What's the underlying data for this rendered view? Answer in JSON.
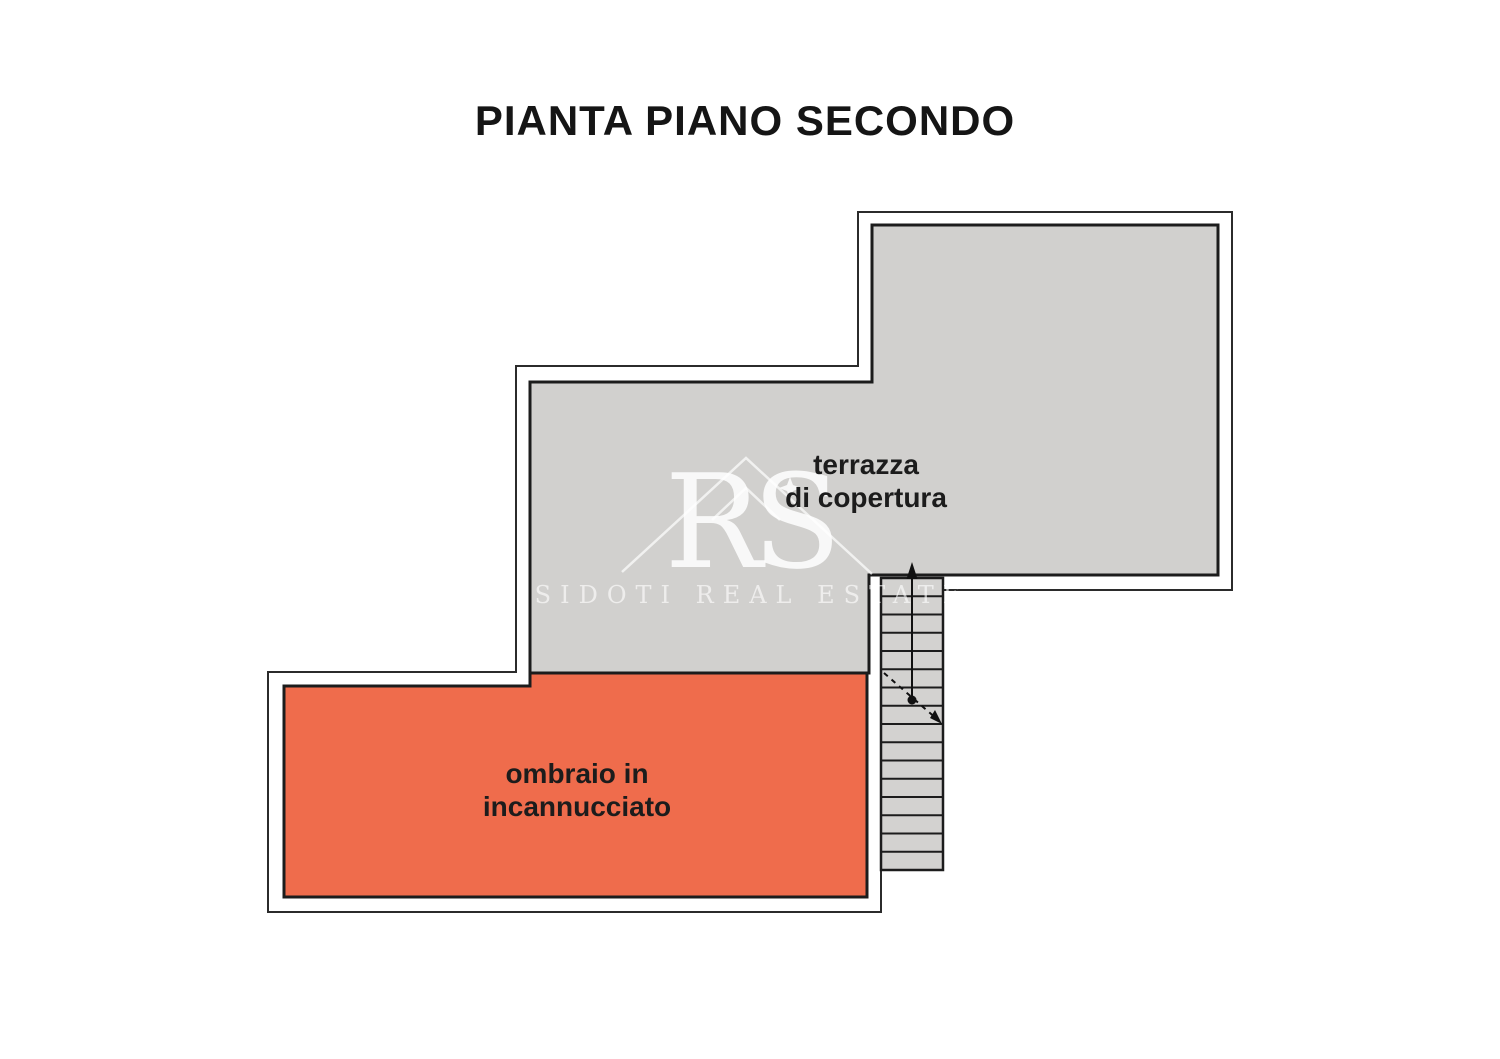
{
  "page": {
    "title": "PIANTA PIANO SECONDO"
  },
  "plan": {
    "outline_color": "#2b2b2b",
    "inner_wall_color": "#1c1c1c",
    "rooms": [
      {
        "id": "terrazza-di-copertura",
        "label_line1": "terrazza",
        "label_line2": "di copertura",
        "fill": "#d1d0ce"
      },
      {
        "id": "ombraio-in-incannucciato",
        "label_line1": "ombraio in",
        "label_line2": "incannucciato",
        "fill": "#ef6c4c"
      }
    ],
    "stairs": {
      "tread_count": 16,
      "fill": "#d3d2d0",
      "symbol": "up-direction-arrow-with-break-line"
    }
  },
  "watermark": {
    "monogram": "RS",
    "brand": "SIDOTI REAL ESTATE",
    "color": "#ffffff"
  }
}
